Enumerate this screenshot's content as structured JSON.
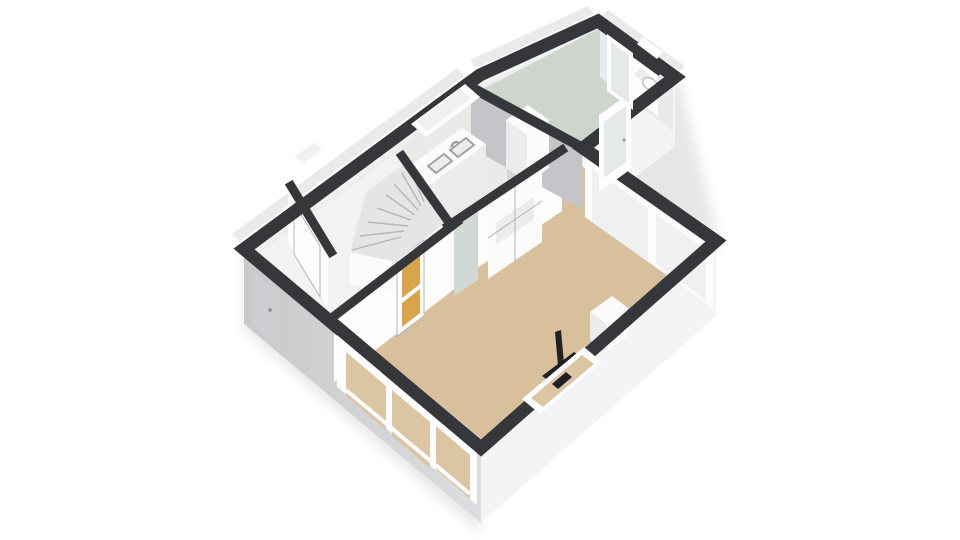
{
  "scene": {
    "type": "3d-floorplan-axonometric",
    "level": "ground-floor",
    "view": "birds-eye-from-south"
  },
  "rooms": [
    {
      "id": "living-room",
      "floor_color_key": "floor_living"
    },
    {
      "id": "kitchen",
      "floor_color_key": "floor_kitchen"
    },
    {
      "id": "hallway-stairs",
      "floor_color_key": "floor_hall"
    },
    {
      "id": "entry-vestibule",
      "floor_color_key": "floor_hall"
    },
    {
      "id": "extension-utility",
      "floor_color_key": "floor_extension"
    },
    {
      "id": "wc-alcove",
      "floor_color_key": "floor_wc"
    }
  ],
  "fixtures": [
    "winder-staircase",
    "kitchen-counter",
    "double-sink",
    "faucet",
    "tall-cabinet",
    "built-in-cupboard",
    "wood-stove-flue",
    "hearth-plate",
    "toilet",
    "furniture-block"
  ],
  "openings": [
    "front-door",
    "front-window-3pane",
    "hall-window",
    "kitchen-window",
    "amber-glass-hall-door",
    "pale-kitchen-door",
    "extension-pale-door",
    "garden-glass-doors",
    "frosted-side-door",
    "glazed-back-door",
    "back-sidelight",
    "side-window"
  ],
  "colors": {
    "background": "#ffffff",
    "wall_top": "#35373a",
    "wall_outer_sw": "#d2d4d6",
    "wall_outer_se": "#f3f4f5",
    "wall_outer_strip": "#e9eaec",
    "wall_face_lit": "#fdfdfd",
    "wall_face_shade": "#c3c5c8",
    "floor_living": "#d9c09c",
    "floor_kitchen": "#e9ebe9",
    "floor_hall": "#f2f2f3",
    "floor_extension": "#cdd5cc",
    "floor_wc": "#eef0ef",
    "glass_exterior": "#eff1f0",
    "glass_floor_tint": "#dcc5a2",
    "door_amber": "#d9a54b",
    "door_pale": "#d2d8d4",
    "frosted": "#e5eae8",
    "stair_tread": "#e4e5e7",
    "stair_line": "#b4b6b8",
    "fixture_white": "#fbfbfc",
    "fixture_shade": "#ececee",
    "sink_rim": "#9fa1a4",
    "flue_black": "#202124",
    "shadow": "#c9c9c9"
  }
}
